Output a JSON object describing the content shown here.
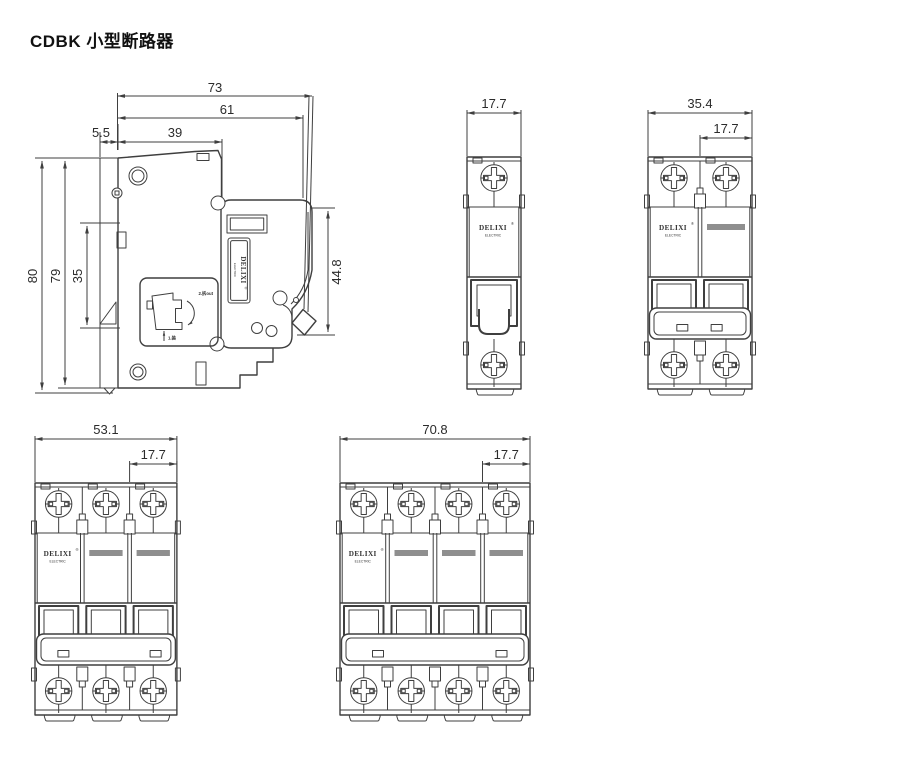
{
  "page_title": "CDBK 小型断路器",
  "brand": {
    "name": "DELIXI",
    "registered": "®",
    "sub": "ELECTRIC"
  },
  "side_view": {
    "dims": {
      "total_depth": "73",
      "body_depth": "61",
      "rail_offset": "5.5",
      "upper_depth": "39",
      "total_height": "80",
      "body_height": "79",
      "rail_window_height": "35",
      "front_face_height": "44.8"
    },
    "install_steps": {
      "step2": "2.拆out",
      "step1": "1.装"
    }
  },
  "front_views": [
    {
      "id": "front-view-1pole",
      "poles": 1,
      "dims": [
        {
          "label": "17.7",
          "span": "full"
        }
      ]
    },
    {
      "id": "front-view-2pole",
      "poles": 2,
      "dims": [
        {
          "label": "35.4",
          "span": "full"
        },
        {
          "label": "17.7",
          "span": "last"
        }
      ]
    },
    {
      "id": "front-view-3pole",
      "poles": 3,
      "dims": [
        {
          "label": "53.1",
          "span": "full"
        },
        {
          "label": "17.7",
          "span": "last"
        }
      ]
    },
    {
      "id": "front-view-4pole",
      "poles": 4,
      "dims": [
        {
          "label": "70.8",
          "span": "full"
        },
        {
          "label": "17.7",
          "span": "last"
        }
      ]
    }
  ],
  "colors": {
    "line": "#3f3f3f",
    "text": "#2b2b2b",
    "gray_bar": "#8f8f8f",
    "background": "#ffffff"
  }
}
